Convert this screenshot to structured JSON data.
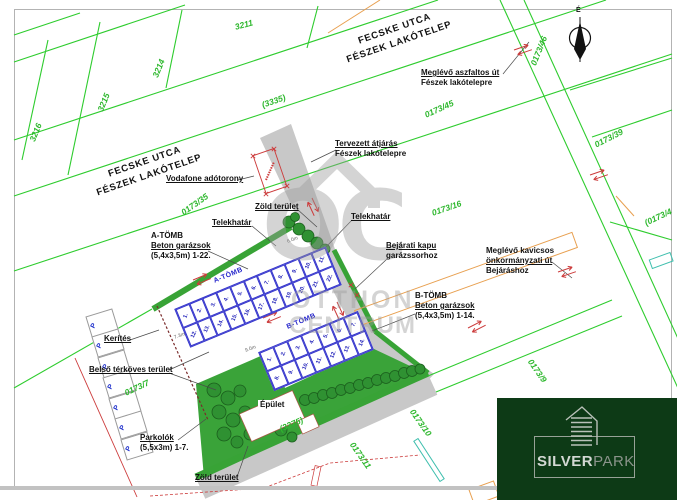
{
  "streets": {
    "line1": "FECSKE UTCA",
    "line2": "FÉSZEK LAKÓTELEP"
  },
  "compass": {
    "north_label": "É"
  },
  "parcels": {
    "p3211": "3211",
    "p3214": "3214",
    "p3215": "3215",
    "p3216": "3216",
    "p3335": "(3335)",
    "p0173_46": "0173/46",
    "p0173_45": "0173/45",
    "p0173_35": "0173/35",
    "p0173_39": "0173/39",
    "p0173_16": "0173/16",
    "p0173_4": "(0173/4",
    "p0173_9": "0173/9",
    "p0173_10": "0173/10",
    "p0173_11": "0173/11",
    "p0173_7": "0173/7",
    "p3375": "(3375)"
  },
  "annotations": {
    "vodafone": "Vodafone adótorony",
    "asphalt_1": "Meglévő aszfaltos út",
    "asphalt_2": "Fészek lakótelepre",
    "passage_1": "Tervezett átjárás",
    "passage_2": "Fészek lakótelepre",
    "green_top": "Zöld terület",
    "boundary_left": "Telekhatár",
    "boundary_right": "Telekhatár",
    "block_a_1": "A-TÖMB",
    "block_a_2": "Beton garázsok",
    "block_a_3": "(5,4x3,5m) 1-22.",
    "gate_1": "Bejárati kapu",
    "gate_2": "garázssorhoz",
    "block_b_1": "B-TÖMB",
    "block_b_2": "Beton garázsok",
    "block_b_3": "(5,4x3,5m) 1-14.",
    "gravel_1": "Meglévő kavicsos",
    "gravel_2": "önkormányzati út",
    "gravel_3": "Bejáráshoz",
    "fence": "Kerítés",
    "paved": "Belső térköves terület",
    "building": "Épület",
    "parking_1": "Parkolók",
    "parking_2": "(5,5x3m) 1-7.",
    "green_bottom": "Zöld terület"
  },
  "garages": {
    "a_label": "A-TÖMB",
    "b_label": "B-TÖMB",
    "a_numbers": [
      "1.",
      "2.",
      "3.",
      "4.",
      "5.",
      "6.",
      "7.",
      "8.",
      "9.",
      "10.",
      "11.",
      "12.",
      "13.",
      "14.",
      "15.",
      "16.",
      "17.",
      "18.",
      "19.",
      "20.",
      "21.",
      "22."
    ],
    "b_numbers": [
      "1.",
      "2.",
      "3.",
      "4.",
      "5.",
      "6.",
      "7.",
      "8.",
      "9.",
      "10.",
      "11.",
      "12.",
      "13.",
      "14."
    ]
  },
  "parking": {
    "stalls": [
      "P",
      "P",
      "P",
      "P",
      "P",
      "P",
      "P"
    ]
  },
  "dimensions": [
    "7.3m",
    "9.0m",
    "6.0m"
  ],
  "watermark": {
    "monogram": "OC",
    "line1": "OTTHON",
    "line2": "CENTRUM"
  },
  "logo": {
    "silver": "SILVER",
    "park": "PARK"
  },
  "colors": {
    "parcel_line_green": "#2ecc2e",
    "band_green": "#38a336",
    "area_green": "#3aa339",
    "garage_blue": "#3535cc",
    "road_gray": "#c8c8c8",
    "arrow_red": "#cc3b3b",
    "fence_dark_red": "#7a2b2b",
    "building_orange": "#e8a050",
    "utility_teal": "#3fbfae",
    "logo_bg_green": "#0d3a16",
    "watermark_gray": "#9b9b9b"
  }
}
